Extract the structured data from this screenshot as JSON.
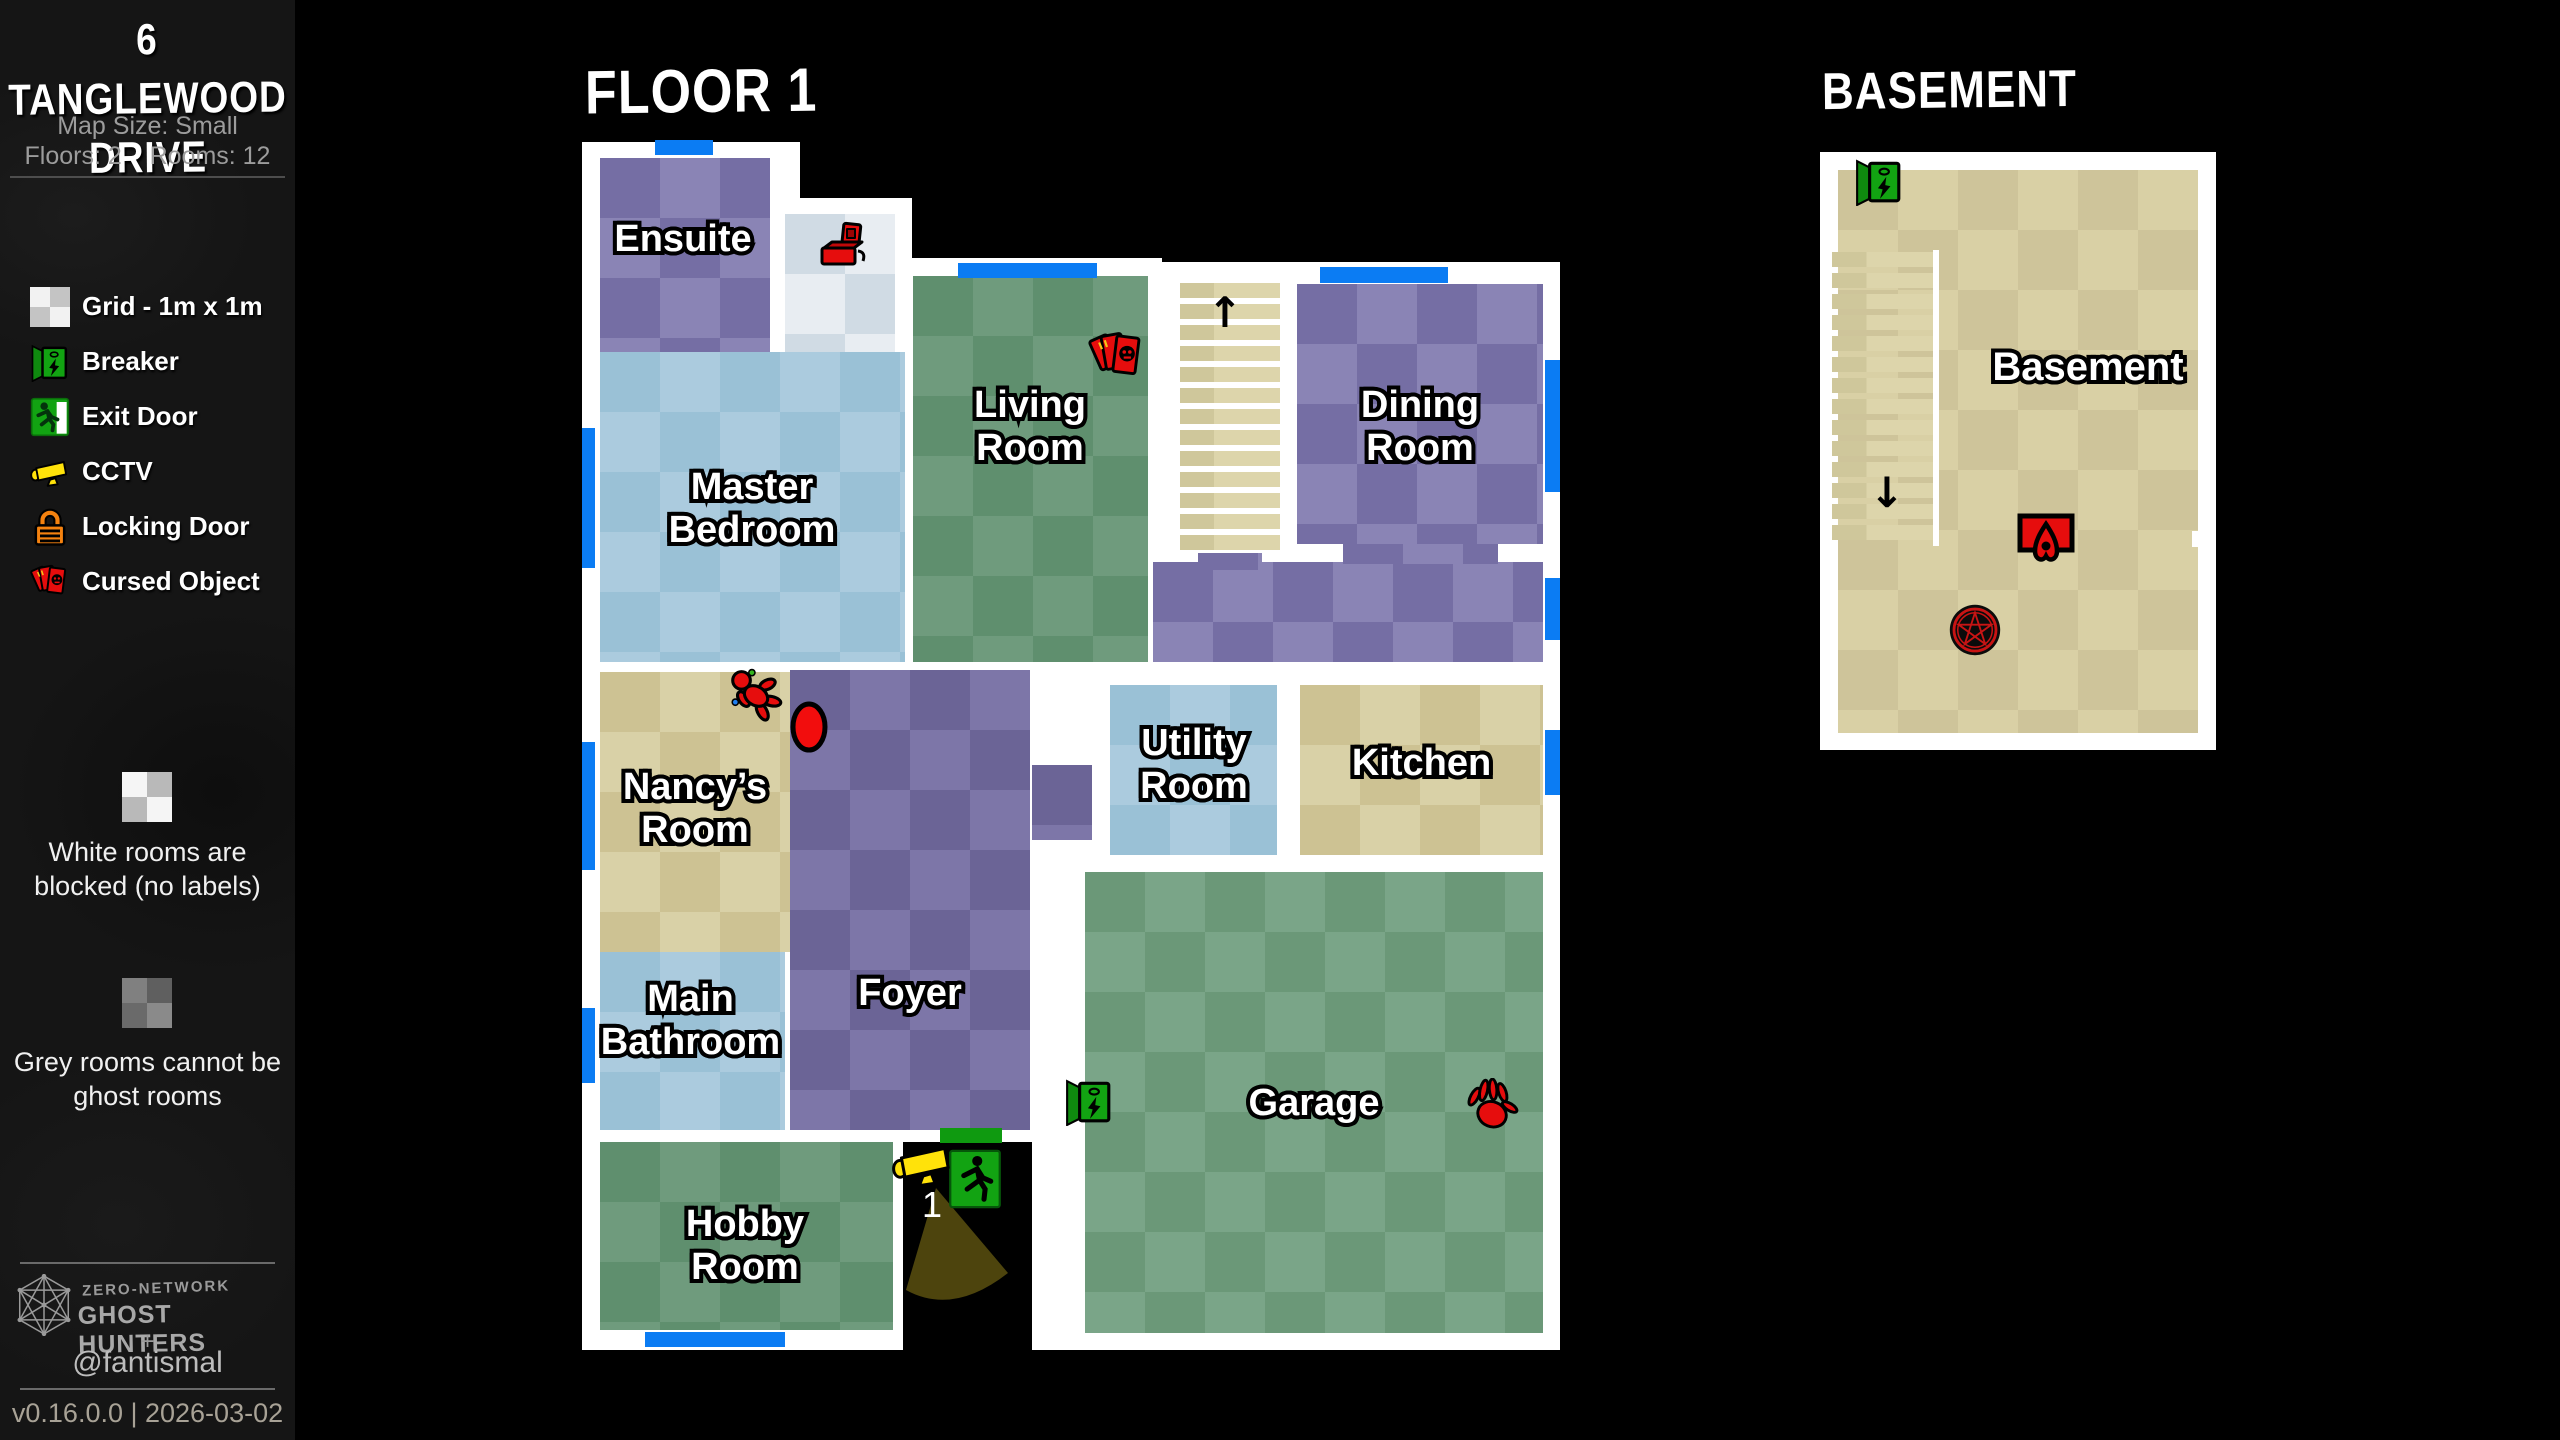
{
  "sidebar": {
    "title_line1": "6 TANGLEWOOD",
    "title_line2": "DRIVE",
    "map_size": "Map Size: Small",
    "floors": "Floors: 2",
    "rooms": "Rooms: 12",
    "legend": [
      {
        "icon": "grid-icon",
        "label": "Grid - 1m x 1m"
      },
      {
        "icon": "breaker-icon",
        "label": "Breaker"
      },
      {
        "icon": "exit-door-icon",
        "label": "Exit Door"
      },
      {
        "icon": "cctv-icon",
        "label": "CCTV"
      },
      {
        "icon": "locking-door-icon",
        "label": "Locking Door"
      },
      {
        "icon": "cursed-object-icon",
        "label": "Cursed Object"
      }
    ],
    "notes": [
      {
        "swatch": "white-checker",
        "text": "White rooms are blocked (no labels)"
      },
      {
        "swatch": "grey-checker",
        "text": "Grey rooms cannot be ghost rooms"
      }
    ],
    "footer": {
      "network": "ZERO-NETWORK",
      "brand": "GHOST HUNTERS",
      "plus": "+",
      "handle": "@fantismal",
      "version": "v0.16.0.0 | 2026-03-02"
    }
  },
  "floor1": {
    "title": "FLOOR 1",
    "rooms": {
      "ensuite": "Ensuite",
      "master": "Master Bedroom",
      "living": "Living Room",
      "dining": "Dining Room",
      "nancy": "Nancy’s Room",
      "utility": "Utility Room",
      "kitchen": "Kitchen",
      "foyer": "Foyer",
      "bathroom": "Main Bathroom",
      "hobby": "Hobby Room",
      "garage": "Garage"
    },
    "stairs_arrow": "↑",
    "camera_label": "1",
    "icons": [
      "music-box",
      "tarot-cards",
      "voodoo-doll",
      "haunted-mirror",
      "monkey-paw",
      "breaker",
      "exit-door",
      "cctv",
      "front-door"
    ]
  },
  "basement": {
    "title": "BASEMENT",
    "room_label": "Basement",
    "stairs_arrow": "↓",
    "icons": [
      "breaker",
      "ouija-planchette",
      "summoning-circle"
    ]
  },
  "colors": {
    "wall": "#ffffff",
    "outside": "#000000",
    "window_blue": "#0b7cf3",
    "purple_room": "#8a84b5",
    "green_room": "#6f9b7d",
    "blue_room": "#abcbde",
    "beige_room": "#d9d1a7",
    "cursed_red": "#e60d0d",
    "exit_green": "#12a312",
    "cctv_yellow": "#ffe20a",
    "lock_orange": "#f5820f",
    "cone_olive": "#4d440d"
  }
}
